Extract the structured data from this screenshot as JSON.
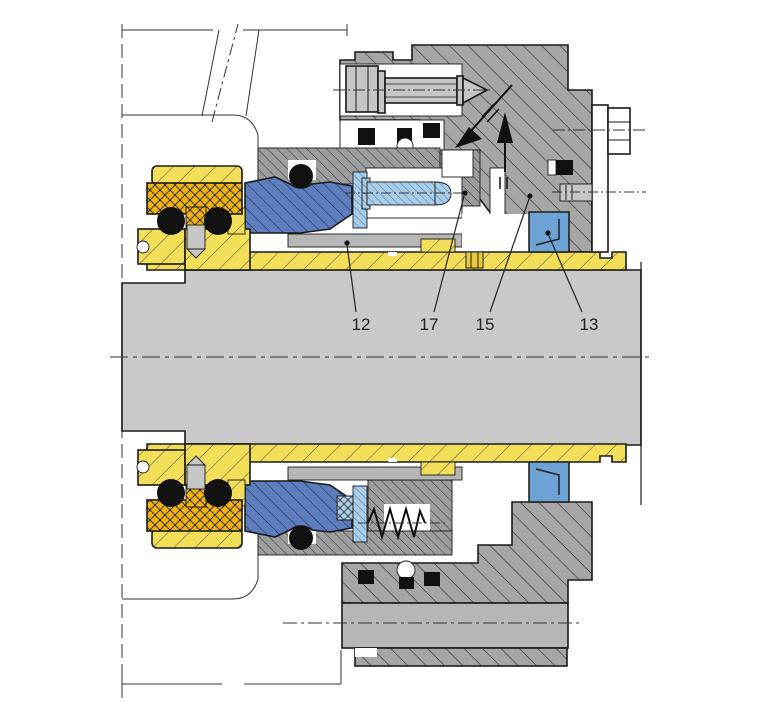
{
  "diagram": {
    "description": "Sectional drawing of a cartridge mechanical seal mounted on a shaft",
    "callouts": [
      {
        "id": "12",
        "label": "12"
      },
      {
        "id": "17",
        "label": "17"
      },
      {
        "id": "15",
        "label": "15"
      },
      {
        "id": "13",
        "label": "13"
      }
    ]
  },
  "palette": {
    "background": "#ffffff",
    "shaft_gray": "#c9c9c9",
    "gland_gray": "#a6a6a6",
    "collar_gray": "#9d9d9d",
    "plain_gray": "#b6b6b6",
    "bolt_gray": "#c6c6c6",
    "sleeve_yellow": "#f3de59",
    "elastomer_orange": "#f1b40d",
    "seal_blue": "#5d7dbd",
    "hardware_lightblue": "#a9cce9",
    "insert_blue": "#6da2d4",
    "oring_black": "#111111",
    "line_black": "#1a1a1a"
  }
}
